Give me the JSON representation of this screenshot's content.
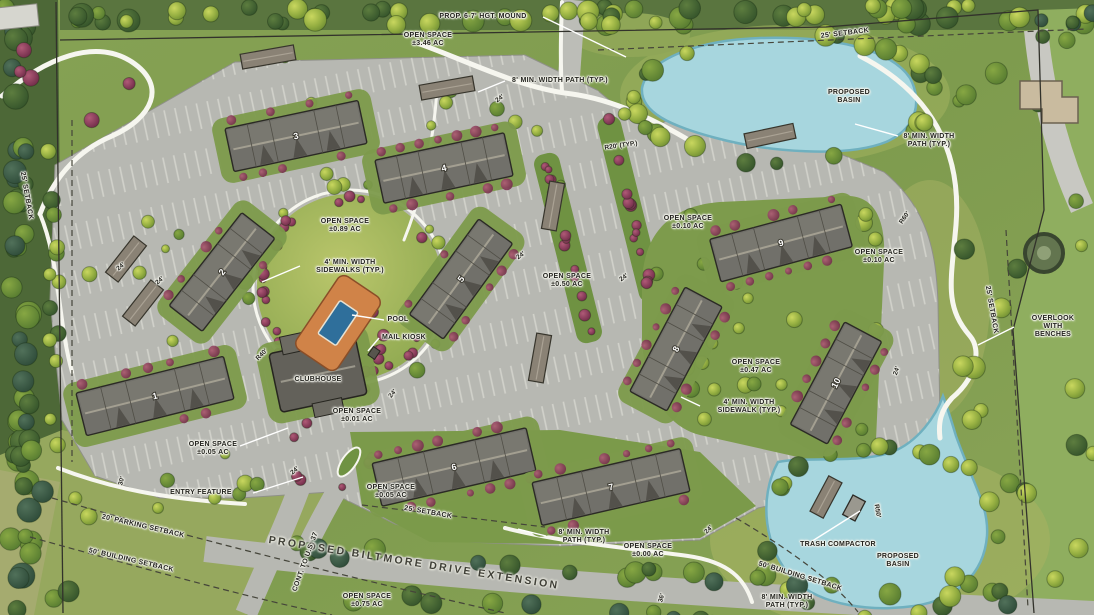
{
  "plan_title": "Proposed multifamily site plan",
  "road_name": "PROPOSED BILTMORE DRIVE EXTENSION",
  "colors": {
    "grass": "#7e9b50",
    "pavement": "#b7b8b2",
    "water": "#a7d6de",
    "roof": "#71706a",
    "shrub": "#7c2f4e",
    "pool_deck": "#d08348",
    "pool_water": "#2f6f9b",
    "path": "#f6f6ef"
  },
  "buildings": [
    {
      "num": "1",
      "x": 155,
      "y": 396,
      "w": 152,
      "h": 44,
      "rot": -14
    },
    {
      "num": "2",
      "x": 222,
      "y": 272,
      "w": 118,
      "h": 42,
      "rot": -52
    },
    {
      "num": "3",
      "x": 296,
      "y": 136,
      "w": 136,
      "h": 44,
      "rot": -12
    },
    {
      "num": "4",
      "x": 444,
      "y": 168,
      "w": 132,
      "h": 44,
      "rot": -12
    },
    {
      "num": "5",
      "x": 461,
      "y": 279,
      "w": 118,
      "h": 42,
      "rot": -54
    },
    {
      "num": "6",
      "x": 454,
      "y": 467,
      "w": 158,
      "h": 44,
      "rot": -13
    },
    {
      "num": "7",
      "x": 611,
      "y": 487,
      "w": 152,
      "h": 44,
      "rot": -13
    },
    {
      "num": "8",
      "x": 676,
      "y": 349,
      "w": 118,
      "h": 42,
      "rot": -62
    },
    {
      "num": "9",
      "x": 781,
      "y": 243,
      "w": 136,
      "h": 44,
      "rot": -15
    },
    {
      "num": "10",
      "x": 836,
      "y": 383,
      "w": 116,
      "h": 42,
      "rot": -62
    }
  ],
  "garages": [
    {
      "x": 126,
      "y": 259,
      "w": 46,
      "h": 16,
      "rot": -52
    },
    {
      "x": 143,
      "y": 303,
      "w": 46,
      "h": 16,
      "rot": -52
    },
    {
      "x": 268,
      "y": 57,
      "w": 54,
      "h": 15,
      "rot": -10
    },
    {
      "x": 447,
      "y": 88,
      "w": 54,
      "h": 15,
      "rot": -10
    },
    {
      "x": 553,
      "y": 206,
      "w": 48,
      "h": 15,
      "rot": -80
    },
    {
      "x": 540,
      "y": 358,
      "w": 48,
      "h": 15,
      "rot": -80
    },
    {
      "x": 770,
      "y": 136,
      "w": 50,
      "h": 15,
      "rot": -12
    },
    {
      "x": 826,
      "y": 497,
      "w": 40,
      "h": 15,
      "rot": -62
    }
  ],
  "site_labels": [
    {
      "t": "PROP. 6-7' HGT. MOUND",
      "x": 483,
      "y": 17,
      "n": "label-prop-mound"
    },
    {
      "t": "OPEN SPACE\n±3.46 AC",
      "x": 428,
      "y": 40,
      "n": "label-open-space-346"
    },
    {
      "t": "8' MIN. WIDTH PATH (TYP.)",
      "x": 560,
      "y": 81,
      "n": "label-path-top"
    },
    {
      "t": "25' SETBACK",
      "x": 845,
      "y": 34,
      "r": -7,
      "n": "label-setback-top"
    },
    {
      "t": "PROPOSED\nBASIN",
      "x": 849,
      "y": 97,
      "n": "label-basin-top"
    },
    {
      "t": "8' MIN. WIDTH\nPATH (TYP.)",
      "x": 929,
      "y": 141,
      "n": "label-path-topright"
    },
    {
      "t": "25' SETBACK",
      "x": 26,
      "y": 196,
      "r": 80,
      "n": "label-setback-left"
    },
    {
      "t": "OPEN SPACE\n±0.89 AC",
      "x": 345,
      "y": 226,
      "n": "label-open-space-089"
    },
    {
      "t": "4' MIN. WIDTH\nSIDEWALKS (TYP.)",
      "x": 350,
      "y": 267,
      "n": "label-sidewalks"
    },
    {
      "t": "POOL",
      "x": 398,
      "y": 320,
      "n": "label-pool"
    },
    {
      "t": "MAIL KIOSK",
      "x": 404,
      "y": 338,
      "n": "label-mail-kiosk"
    },
    {
      "t": "CLUBHOUSE",
      "x": 318,
      "y": 380,
      "n": "label-clubhouse"
    },
    {
      "t": "OPEN SPACE\n±0.50 AC",
      "x": 567,
      "y": 281,
      "n": "label-open-space-050"
    },
    {
      "t": "OPEN SPACE\n±0.10 AC",
      "x": 688,
      "y": 223,
      "n": "label-open-space-010a"
    },
    {
      "t": "OPEN SPACE\n±0.10 AC",
      "x": 879,
      "y": 257,
      "n": "label-open-space-010b"
    },
    {
      "t": "OPEN SPACE\n±0.47 AC",
      "x": 756,
      "y": 367,
      "n": "label-open-space-047"
    },
    {
      "t": "4' MIN. WIDTH\nSIDEWALK (TYP.)",
      "x": 749,
      "y": 407,
      "n": "label-sidewalk"
    },
    {
      "t": "OVERLOOK\nWITH BENCHES",
      "x": 1053,
      "y": 327,
      "n": "label-overlook"
    },
    {
      "t": "25' SETBACK",
      "x": 991,
      "y": 310,
      "r": 80,
      "n": "label-setback-right"
    },
    {
      "t": "OPEN SPACE\n±0.01 AC",
      "x": 357,
      "y": 416,
      "n": "label-open-space-001"
    },
    {
      "t": "OPEN SPACE\n±0.05 AC",
      "x": 213,
      "y": 449,
      "n": "label-open-space-005a"
    },
    {
      "t": "OPEN SPACE\n±0.05 AC",
      "x": 391,
      "y": 492,
      "n": "label-open-space-005b"
    },
    {
      "t": "25' SETBACK",
      "x": 428,
      "y": 513,
      "r": 10,
      "n": "label-setback-bldg7"
    },
    {
      "t": "ENTRY FEATURE",
      "x": 201,
      "y": 493,
      "n": "label-entry-feature"
    },
    {
      "t": "20' PARKING SETBACK",
      "x": 143,
      "y": 527,
      "r": 13,
      "n": "label-parking-setback"
    },
    {
      "t": "50' BUILDING SETBACK",
      "x": 131,
      "y": 561,
      "r": 13,
      "n": "label-building-setback-sw"
    },
    {
      "t": "PROPOSED BILTMORE DRIVE EXTENSION",
      "x": 414,
      "y": 563,
      "r": 9,
      "cls": "road",
      "n": "label-biltmore-drive"
    },
    {
      "t": "CONT. TO U.S. 37",
      "x": 306,
      "y": 562,
      "r": -70,
      "n": "label-us37"
    },
    {
      "t": "OPEN SPACE\n±0.75 AC",
      "x": 367,
      "y": 601,
      "n": "label-open-space-075"
    },
    {
      "t": "8' MIN. WIDTH\nPATH (TYP.)",
      "x": 584,
      "y": 537,
      "n": "label-path-bottom"
    },
    {
      "t": "OPEN SPACE\n±0.00 AC",
      "x": 648,
      "y": 551,
      "n": "label-open-space-000"
    },
    {
      "t": "TRASH COMPACTOR",
      "x": 838,
      "y": 545,
      "n": "label-trash-compactor"
    },
    {
      "t": "PROPOSED\nBASIN",
      "x": 898,
      "y": 561,
      "n": "label-basin-bottom"
    },
    {
      "t": "50' BUILDING SETBACK",
      "x": 800,
      "y": 577,
      "r": 17,
      "n": "label-building-setback-se"
    },
    {
      "t": "8' MIN. WIDTH\nPATH (TYP.)",
      "x": 787,
      "y": 602,
      "n": "label-path-bottomright"
    }
  ],
  "dim_labels": [
    {
      "t": "R20' (TYP.)",
      "x": 621,
      "y": 146,
      "r": -8
    },
    {
      "t": "R60'",
      "x": 905,
      "y": 218,
      "r": -55
    },
    {
      "t": "R50'",
      "x": 877,
      "y": 511,
      "r": 80
    },
    {
      "t": "R40'",
      "x": 262,
      "y": 355,
      "r": -45
    },
    {
      "t": "24'",
      "x": 521,
      "y": 256,
      "r": -35
    },
    {
      "t": "24'",
      "x": 624,
      "y": 278,
      "r": -35
    },
    {
      "t": "24'",
      "x": 500,
      "y": 99,
      "r": -35
    },
    {
      "t": "24'",
      "x": 121,
      "y": 267,
      "r": -40
    },
    {
      "t": "24'",
      "x": 160,
      "y": 281,
      "r": -40
    },
    {
      "t": "24'",
      "x": 897,
      "y": 371,
      "r": -70
    },
    {
      "t": "24'",
      "x": 709,
      "y": 530,
      "r": -45
    },
    {
      "t": "24'",
      "x": 295,
      "y": 471,
      "r": -40
    },
    {
      "t": "24'",
      "x": 393,
      "y": 394,
      "r": -50
    },
    {
      "t": "30'",
      "x": 122,
      "y": 481,
      "r": -75
    },
    {
      "t": "36'",
      "x": 662,
      "y": 598,
      "r": -75
    }
  ]
}
